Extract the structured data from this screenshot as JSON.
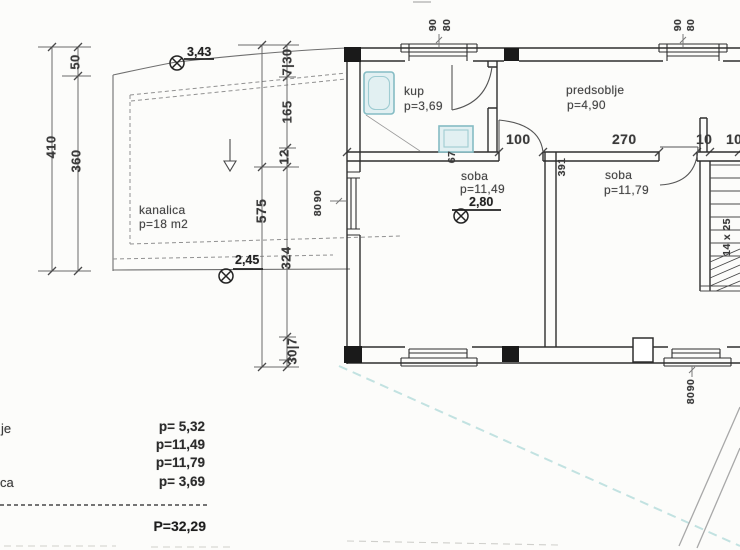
{
  "drawing": {
    "kind": "floor-plan scan"
  },
  "colors": {
    "wall": "#2e2e2e",
    "dimline": "#6a6a6a",
    "fixture_fill": "#e2f0f2",
    "fixture_stroke": "#85bcc4",
    "utility_cyan": "#c2e2e1",
    "column": "#1a1a1a"
  },
  "rooms": {
    "kup": {
      "name": "kup",
      "area": "p=3,69"
    },
    "predsoblje": {
      "name": "predsoblje",
      "area": "p=4,90"
    },
    "soba1": {
      "name": "soba",
      "area": "p=11,49"
    },
    "soba2": {
      "name": "soba",
      "area": "p=11,79"
    },
    "kanalica": {
      "name": "kanalica",
      "area": "p=18 m2"
    }
  },
  "markers": {
    "benchmark_top": "3,43",
    "benchmark_bottom": "2,45",
    "floor_elevation": "2,80"
  },
  "dims": {
    "left_upper": "50",
    "left_total": "410",
    "left_lower": "360",
    "chain_top": "7|30",
    "chain_165": "165",
    "chain_12": "12",
    "chain_total": "575",
    "chain_324": "324",
    "chain_bottom": "30|7",
    "door_100": "100",
    "wall_270": "270",
    "seg_10a": "10",
    "seg_10b": "10",
    "jamb_67": "67",
    "wall_391": "391",
    "stair_steps": "14 x 25"
  },
  "windows": {
    "top_kup": {
      "w": "90",
      "h": "80"
    },
    "top_predsoblje": {
      "w": "90",
      "h": "80"
    },
    "left_wall": {
      "w": "90",
      "h": "80"
    },
    "bottom_right": {
      "w": "90",
      "h": "80"
    }
  },
  "legend": {
    "rows": [
      {
        "label": "je",
        "value": "p= 5,32"
      },
      {
        "label": "",
        "value": "p=11,49"
      },
      {
        "label": "",
        "value": "p=11,79"
      },
      {
        "label": "ca",
        "value": "p= 3,69"
      }
    ],
    "total": "P=32,29"
  }
}
